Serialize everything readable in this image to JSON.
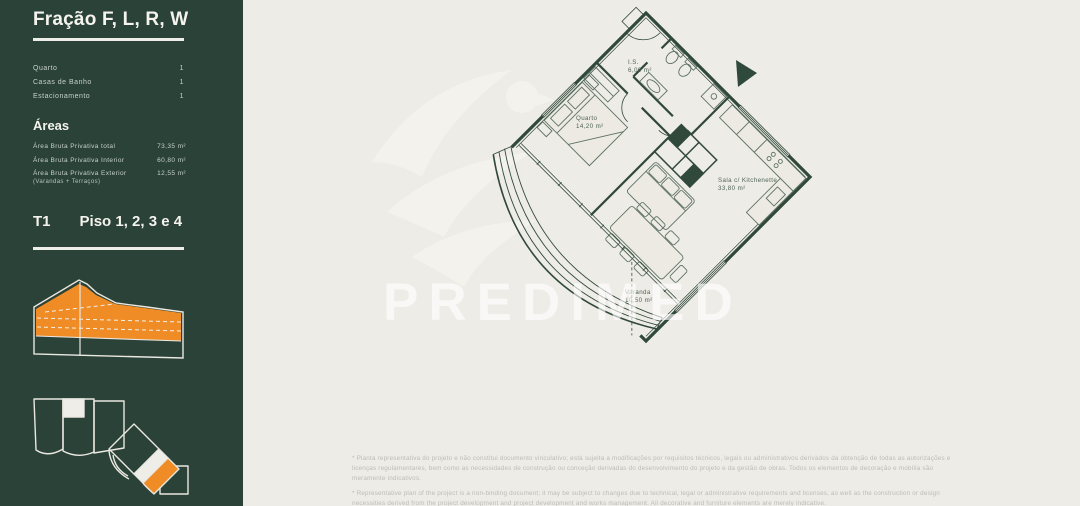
{
  "sidebar": {
    "title": "Fração F, L, R, W",
    "specs": [
      {
        "label": "Quarto",
        "value": "1"
      },
      {
        "label": "Casas de Banho",
        "value": "1"
      },
      {
        "label": "Estacionamento",
        "value": "1"
      }
    ],
    "areas_heading": "Áreas",
    "areas": [
      {
        "label": "Área Bruta Privativa total",
        "sublabel": "",
        "value": "73,35 m²"
      },
      {
        "label": "Área Bruta Privativa Interior",
        "sublabel": "",
        "value": "60,80 m²"
      },
      {
        "label": "Área Bruta Privativa Exterior",
        "sublabel": "(Varandas + Terraços)",
        "value": "12,55 m²"
      }
    ],
    "typology": "T1",
    "floors": "Piso 1, 2, 3 e 4",
    "colors": {
      "panel_green": "#2A4238",
      "highlight_orange": "#EF8C26",
      "outline_light": "#EAE8E1"
    }
  },
  "plan": {
    "watermark": "PREDIMED",
    "rooms": [
      {
        "name": "I.S.",
        "area": "6,00 m²"
      },
      {
        "name": "Quarto",
        "area": "14,20 m²"
      },
      {
        "name": "Sala c/ Kitchenette",
        "area": "33,80 m²"
      },
      {
        "name": "Varanda",
        "area": "10,50 m²"
      }
    ]
  },
  "footnotes": {
    "pt": "* Planta representativa do projeto e não constitui documento vinculativo; está sujeita a modificações por requisitos técnicos, legais ou administrativos derivados da obtenção de todas as autorizações e licenças regulamentares, bem como as necessidades de construção ou conceção derivadas do desenvolvimento do projeto e da gestão de obras. Todos os elementos de decoração e mobília são meramente indicativos.",
    "en": "* Representative plan of the project is a non-binding document; it may be subject to changes due to technical, legal or administrative requirements and licenses, as well as the construction or design necessities derived from the project development and project development and works management. All decorative and furniture elements are merely indicative."
  }
}
